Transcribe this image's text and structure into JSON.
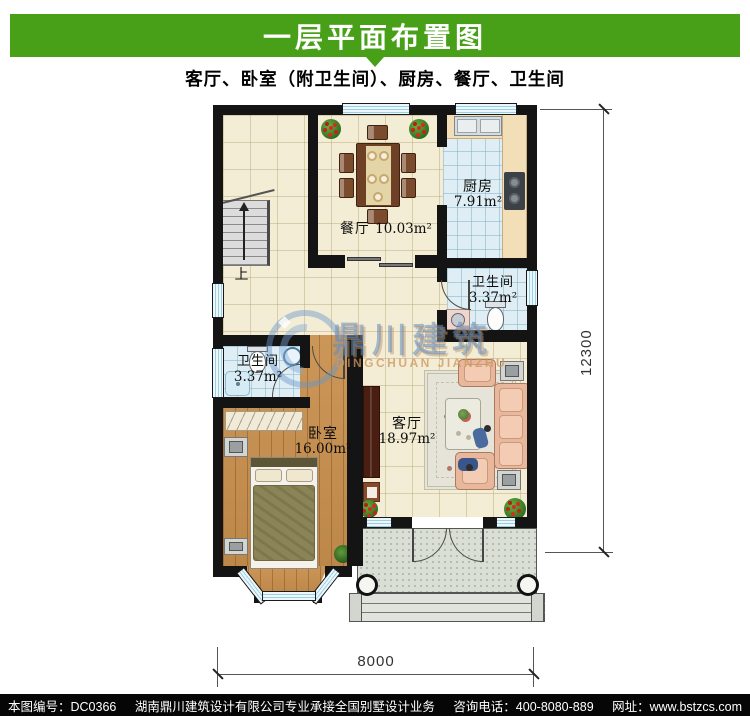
{
  "header": {
    "title": "一层平面布置图"
  },
  "subtitle": "客厅、卧室（附卫生间）、厨房、餐厅、卫生间",
  "rooms": {
    "dining": {
      "name": "餐厅",
      "area": "10.03m²"
    },
    "kitchen": {
      "name": "厨房",
      "area": "7.91m²"
    },
    "bath_right": {
      "name": "卫生间",
      "area": "3.37m²"
    },
    "bath_left": {
      "name": "卫生间",
      "area": "3.37m²"
    },
    "bedroom": {
      "name": "卧室",
      "area": "16.00m²"
    },
    "living": {
      "name": "客厅",
      "area": "18.97m²"
    }
  },
  "stairs": {
    "up_label": "上"
  },
  "dimensions": {
    "bottom": "8000",
    "right": "12300"
  },
  "watermark": {
    "cn": "鼎川建筑",
    "en": "DINGCHUAN JIANZHU"
  },
  "footer": {
    "drawing_no": "本图编号：DC0366",
    "company": "湖南鼎川建筑设计有限公司专业承接全国别墅设计业务",
    "phone": "咨询电话：400-8080-889",
    "website": "网址：www.bstzcs.com"
  },
  "colors": {
    "header_green": "#47a017",
    "wall": "#141414",
    "cream_tile": "#f3edd6",
    "blue_tile": "#dfeef4",
    "wood_floor": "#c8904e",
    "counter": "#f2dfb7",
    "porch": "#dadfd6",
    "sofa": "#e9b79b",
    "footer_bg": "#060606"
  }
}
